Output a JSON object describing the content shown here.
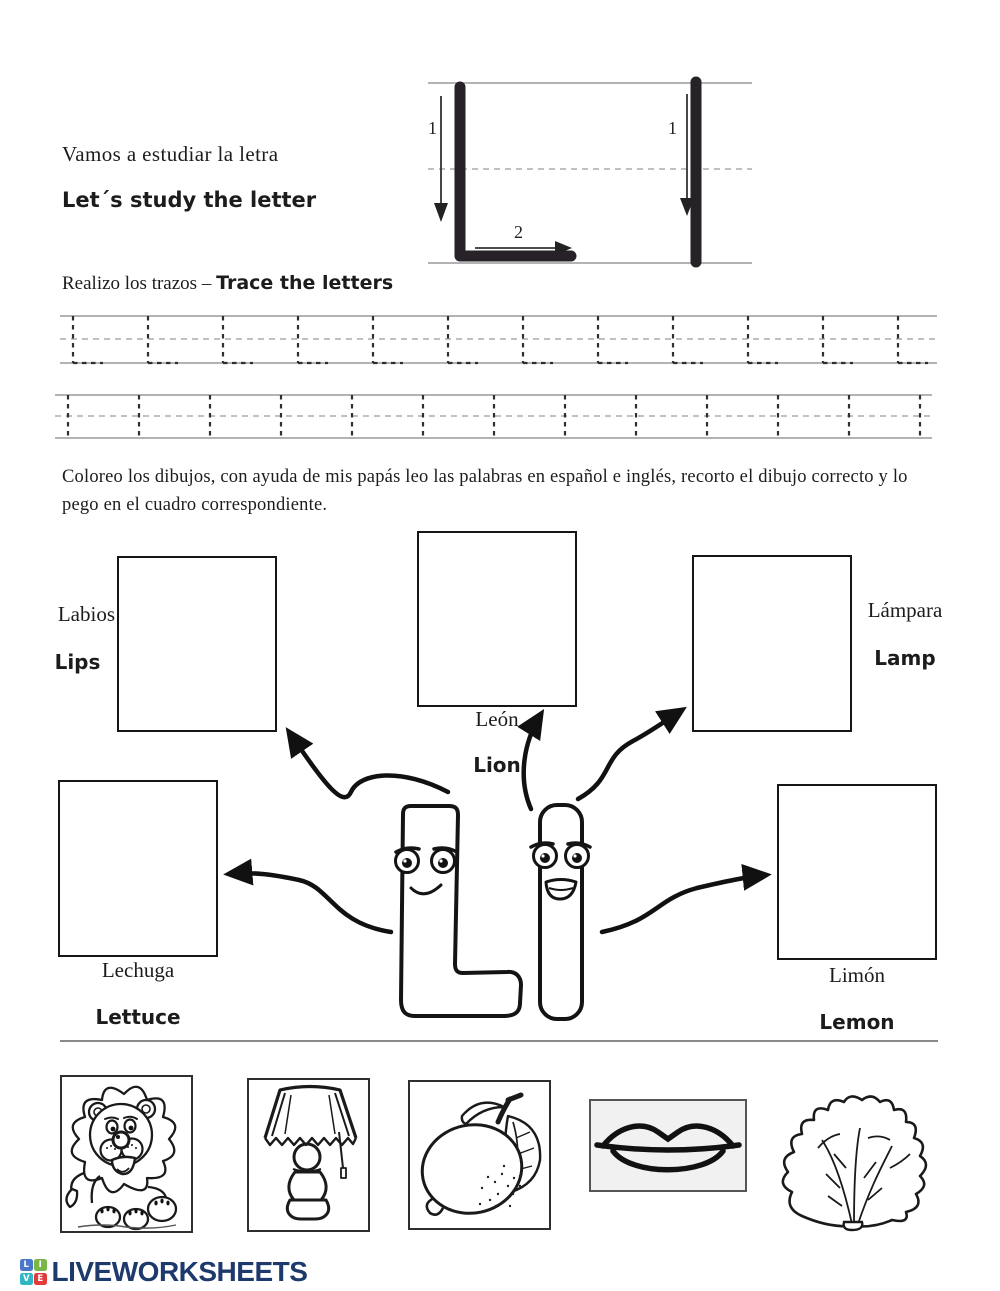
{
  "header": {
    "title_es": "Vamos a estudiar la letra",
    "title_en": "Let´s study the letter",
    "stroke_diagram": {
      "capital_stroke1": "1",
      "capital_stroke2": "2",
      "lower_stroke1": "1"
    }
  },
  "trace": {
    "heading_es": "Realizo los trazos –",
    "heading_en": "Trace the letters",
    "capital_glyph": "L",
    "lower_glyph": "l",
    "capital_row_count": 12,
    "lower_row_count": 13
  },
  "instructions": "Coloreo los dibujos, con ayuda de mis papás leo las palabras en español e inglés, recorto el dibujo correcto y lo pego en el cuadro correspondiente.",
  "matching": {
    "labios": {
      "es": "Labios",
      "en": "Lips"
    },
    "leon": {
      "es": "León",
      "en": "Lion"
    },
    "lampara": {
      "es": "Lámpara",
      "en": "Lamp"
    },
    "lechuga": {
      "es": "Lechuga",
      "en": "Lettuce"
    },
    "limon": {
      "es": "Limón",
      "en": "Lemon"
    }
  },
  "cutouts": [
    "lion-drawing",
    "lamp-drawing",
    "lemon-drawing",
    "lips-drawing",
    "lettuce-drawing"
  ],
  "footer": {
    "brand": "LIVEWORKSHEETS",
    "logo_letters": [
      "L",
      "I",
      "V",
      "E"
    ],
    "logo_colors": [
      "#4a77c9",
      "#7ab648",
      "#31b7c3",
      "#e23b3b"
    ],
    "brand_color": "#1e3a6d"
  }
}
